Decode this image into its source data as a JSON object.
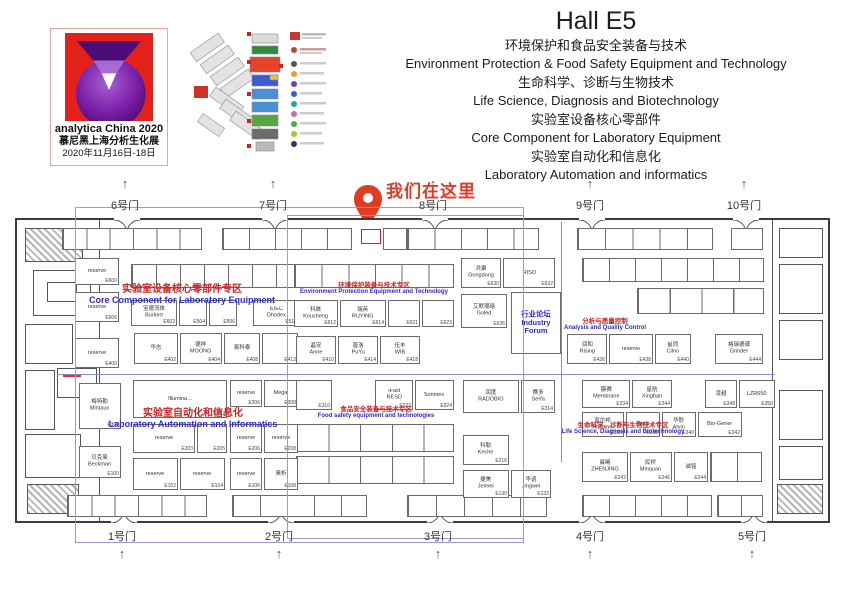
{
  "logo": {
    "name": "analytica China 2020",
    "subtitle": "慕尼黑上海分析生化展",
    "dates": "2020年11月16日-18日"
  },
  "header": {
    "title": "Hall E5",
    "lines": [
      "环境保护和食品安全装备与技术",
      "Environment Protection  & Food Safety Equipment and Technology",
      "生命科学、诊断与生物技术",
      "Life Science, Diagnosis and Biotechnology",
      "实验室设备核心零部件",
      "Core Component for Laboratory Equipment",
      "实验室自动化和信息化",
      "Laboratory Automation and informatics"
    ]
  },
  "marker": {
    "label": "我们在这里"
  },
  "gates": {
    "top": [
      {
        "label": "6号门",
        "x": 125
      },
      {
        "label": "7号门",
        "x": 273
      },
      {
        "label": "8号门",
        "x": 433
      },
      {
        "label": "9号门",
        "x": 590
      },
      {
        "label": "10号门",
        "x": 744
      }
    ],
    "bottom": [
      {
        "label": "1号门",
        "x": 122
      },
      {
        "label": "2号门",
        "x": 279
      },
      {
        "label": "3号门",
        "x": 438
      },
      {
        "label": "4号门",
        "x": 590
      },
      {
        "label": "5号门",
        "x": 752
      }
    ]
  },
  "zones": [
    {
      "cn": "实验室设备核心零部件专区",
      "en": "Core Component for Laboratory Equipment",
      "x": 82,
      "y": 280,
      "w": 200,
      "size": "lg"
    },
    {
      "cn": "环境保护装备与技术专区",
      "en": "Environment Protection Equipment and Technology",
      "x": 288,
      "y": 279,
      "w": 172,
      "size": "sm"
    },
    {
      "cn": "分析与质量控制",
      "en": "Analysis and Quality Control",
      "x": 540,
      "y": 315,
      "w": 130,
      "size": "sm"
    },
    {
      "cn": "实验室自动化和信息化",
      "en": "Laboratory Automation and Informatics",
      "x": 95,
      "y": 404,
      "w": 196,
      "size": "lg"
    },
    {
      "cn": "食品安全装备与技术专区",
      "en": "Food safety equipment and technologies",
      "x": 292,
      "y": 403,
      "w": 168,
      "size": "sm"
    },
    {
      "cn": "生命科学、诊断与生物技术专区",
      "en": "Life Science, Diagnosis and Biotechnology",
      "x": 542,
      "y": 419,
      "w": 162,
      "size": "sm"
    }
  ],
  "booths": [
    {
      "name": "reserve",
      "num": "E600",
      "x": 58,
      "y": 38,
      "w": 44,
      "h": 27
    },
    {
      "name": "reserve",
      "num": "E606",
      "x": 58,
      "y": 72,
      "w": 44,
      "h": 30
    },
    {
      "name": "reserve",
      "num": "E400",
      "x": 58,
      "y": 118,
      "w": 44,
      "h": 30
    },
    {
      "name": "宝德流体\nBurkert",
      "num": "E602",
      "x": 114,
      "y": 80,
      "w": 46,
      "h": 26
    },
    {
      "name": "",
      "num": "E504",
      "x": 162,
      "y": 80,
      "w": 28,
      "h": 26
    },
    {
      "name": "",
      "num": "E506",
      "x": 192,
      "y": 80,
      "w": 28,
      "h": 26
    },
    {
      "name": "IDEC\nDhodex",
      "num": "E510",
      "x": 236,
      "y": 80,
      "w": 46,
      "h": 26
    },
    {
      "name": "华志",
      "num": "E402",
      "x": 117,
      "y": 113,
      "w": 44,
      "h": 31
    },
    {
      "name": "德祥\nMOONG",
      "num": "E404",
      "x": 163,
      "y": 113,
      "w": 42,
      "h": 31
    },
    {
      "name": "易科泰",
      "num": "E408",
      "x": 207,
      "y": 113,
      "w": 36,
      "h": 31
    },
    {
      "name": "",
      "num": "E412",
      "x": 245,
      "y": 113,
      "w": 36,
      "h": 31
    },
    {
      "name": "科晟\nKousheng",
      "num": "E612",
      "x": 277,
      "y": 80,
      "w": 44,
      "h": 27
    },
    {
      "name": "瑞英\nRUYING",
      "num": "E614",
      "x": 323,
      "y": 80,
      "w": 46,
      "h": 27
    },
    {
      "name": "",
      "num": "E621",
      "x": 371,
      "y": 80,
      "w": 32,
      "h": 27
    },
    {
      "name": "",
      "num": "E623",
      "x": 405,
      "y": 80,
      "w": 32,
      "h": 27
    },
    {
      "name": "晶安\nAnne",
      "num": "E410",
      "x": 279,
      "y": 116,
      "w": 40,
      "h": 28
    },
    {
      "name": "普洛\nPuYu",
      "num": "E414",
      "x": 321,
      "y": 116,
      "w": 40,
      "h": 28
    },
    {
      "name": "伍丰\nWIB",
      "num": "E418",
      "x": 363,
      "y": 116,
      "w": 40,
      "h": 28
    },
    {
      "name": "共聚\nGongdong",
      "num": "E630",
      "x": 444,
      "y": 38,
      "w": 40,
      "h": 30
    },
    {
      "name": "RISO",
      "num": "E632",
      "x": 486,
      "y": 38,
      "w": 52,
      "h": 30
    },
    {
      "name": "艾默璎珞\nGoled",
      "num": "E636",
      "x": 444,
      "y": 74,
      "w": 46,
      "h": 34
    },
    {
      "name": "行业论坛\nIndustry Forum",
      "num": "",
      "style": "forum",
      "x": 494,
      "y": 72,
      "w": 50,
      "h": 62
    },
    {
      "name": "润和\nRising",
      "num": "E436",
      "x": 550,
      "y": 114,
      "w": 40,
      "h": 30
    },
    {
      "name": "reserve",
      "num": "E438",
      "x": 592,
      "y": 114,
      "w": 44,
      "h": 30
    },
    {
      "name": "星同\nCilno",
      "num": "E440",
      "x": 638,
      "y": 114,
      "w": 36,
      "h": 30
    },
    {
      "name": "格瑞德谱\nGrinder",
      "num": "E444",
      "x": 698,
      "y": 114,
      "w": 48,
      "h": 30
    },
    {
      "name": "梅特勒\nMintaux",
      "num": "E300",
      "x": 62,
      "y": 163,
      "w": 42,
      "h": 46
    },
    {
      "name": "贝克曼\nBeckman",
      "num": "E100",
      "x": 62,
      "y": 226,
      "w": 42,
      "h": 32
    },
    {
      "name": "Illumina…",
      "num": "E302",
      "x": 116,
      "y": 160,
      "w": 94,
      "h": 38
    },
    {
      "name": "reserve",
      "num": "E306",
      "x": 213,
      "y": 160,
      "w": 32,
      "h": 27
    },
    {
      "name": "Mega",
      "num": "E308",
      "x": 247,
      "y": 160,
      "w": 34,
      "h": 27
    },
    {
      "name": "reserve",
      "num": "E203",
      "x": 116,
      "y": 204,
      "w": 62,
      "h": 29
    },
    {
      "name": "",
      "num": "E205",
      "x": 180,
      "y": 204,
      "w": 30,
      "h": 29
    },
    {
      "name": "reserve",
      "num": "E206",
      "x": 213,
      "y": 204,
      "w": 32,
      "h": 29
    },
    {
      "name": "reserve",
      "num": "E208",
      "x": 247,
      "y": 204,
      "w": 34,
      "h": 29
    },
    {
      "name": "reserve",
      "num": "E102",
      "x": 116,
      "y": 238,
      "w": 45,
      "h": 32
    },
    {
      "name": "reserve",
      "num": "E104",
      "x": 163,
      "y": 238,
      "w": 45,
      "h": 32
    },
    {
      "name": "reserve",
      "num": "E106",
      "x": 213,
      "y": 238,
      "w": 32,
      "h": 32
    },
    {
      "name": "奥析",
      "num": "E108",
      "x": 247,
      "y": 238,
      "w": 34,
      "h": 32
    },
    {
      "name": "",
      "num": "E310",
      "x": 279,
      "y": 160,
      "w": 36,
      "h": 30
    },
    {
      "name": "iFast\nRESD",
      "num": "E322",
      "x": 358,
      "y": 160,
      "w": 38,
      "h": 30
    },
    {
      "name": "Sonmex",
      "num": "E324",
      "x": 398,
      "y": 160,
      "w": 39,
      "h": 30
    },
    {
      "name": "润度\nRADOBIO",
      "num": "",
      "x": 446,
      "y": 160,
      "w": 56,
      "h": 33
    },
    {
      "name": "赛多\nSerfa",
      "num": "E314",
      "x": 504,
      "y": 160,
      "w": 34,
      "h": 33
    },
    {
      "name": "科勒\nKeche",
      "num": "E216",
      "x": 446,
      "y": 215,
      "w": 46,
      "h": 30
    },
    {
      "name": "捷美\nJeimei",
      "num": "E130",
      "x": 446,
      "y": 250,
      "w": 46,
      "h": 28
    },
    {
      "name": "华谊\nJingwei",
      "num": "E132",
      "x": 494,
      "y": 250,
      "w": 40,
      "h": 28
    },
    {
      "name": "膜赛\nMembrane",
      "num": "E334",
      "x": 565,
      "y": 160,
      "w": 48,
      "h": 28
    },
    {
      "name": "星航\nXinghan",
      "num": "E344",
      "x": 615,
      "y": 160,
      "w": 40,
      "h": 28
    },
    {
      "name": "凌越",
      "num": "E348",
      "x": 688,
      "y": 160,
      "w": 32,
      "h": 28
    },
    {
      "name": "LZR650",
      "num": "E350",
      "x": 722,
      "y": 160,
      "w": 36,
      "h": 28
    },
    {
      "name": "富尔邦\nFulltime",
      "num": "E338",
      "x": 565,
      "y": 192,
      "w": 42,
      "h": 25
    },
    {
      "name": "Tan's",
      "num": "E336",
      "x": 609,
      "y": 192,
      "w": 34,
      "h": 25
    },
    {
      "name": "华聆\nAtvio",
      "num": "E340",
      "x": 645,
      "y": 192,
      "w": 34,
      "h": 25
    },
    {
      "name": "Bio-Gener",
      "num": "E342",
      "x": 681,
      "y": 192,
      "w": 44,
      "h": 25
    },
    {
      "name": "晨曦\nZHENJING",
      "num": "E242",
      "x": 565,
      "y": 232,
      "w": 46,
      "h": 30
    },
    {
      "name": "民桥\nMinquan",
      "num": "E246",
      "x": 613,
      "y": 232,
      "w": 42,
      "h": 30
    },
    {
      "name": "诚铭",
      "num": "E244",
      "x": 657,
      "y": 232,
      "w": 34,
      "h": 30
    }
  ],
  "booth_strips": [
    {
      "x": 45,
      "y": 8,
      "w": 140,
      "h": 22,
      "cells": 6
    },
    {
      "x": 205,
      "y": 8,
      "w": 130,
      "h": 22,
      "cells": 5
    },
    {
      "x": 366,
      "y": 8,
      "w": 24,
      "h": 22,
      "cells": 1
    },
    {
      "x": 390,
      "y": 8,
      "w": 132,
      "h": 22,
      "cells": 5
    },
    {
      "x": 560,
      "y": 8,
      "w": 136,
      "h": 22,
      "cells": 5
    },
    {
      "x": 714,
      "y": 8,
      "w": 32,
      "h": 22,
      "cells": 1
    },
    {
      "x": 114,
      "y": 44,
      "w": 168,
      "h": 24,
      "cells": 7
    },
    {
      "x": 277,
      "y": 44,
      "w": 160,
      "h": 24,
      "cells": 6
    },
    {
      "x": 565,
      "y": 38,
      "w": 182,
      "h": 24,
      "cells": 7
    },
    {
      "x": 620,
      "y": 68,
      "w": 127,
      "h": 26,
      "cells": 4
    },
    {
      "x": 279,
      "y": 204,
      "w": 158,
      "h": 28,
      "cells": 5
    },
    {
      "x": 279,
      "y": 236,
      "w": 158,
      "h": 28,
      "cells": 5
    },
    {
      "x": 693,
      "y": 232,
      "w": 52,
      "h": 30,
      "cells": 2
    },
    {
      "x": 50,
      "y": 275,
      "w": 140,
      "h": 22,
      "cells": 6
    },
    {
      "x": 215,
      "y": 275,
      "w": 135,
      "h": 22,
      "cells": 5
    },
    {
      "x": 390,
      "y": 275,
      "w": 140,
      "h": 22,
      "cells": 5
    },
    {
      "x": 565,
      "y": 275,
      "w": 130,
      "h": 22,
      "cells": 5
    },
    {
      "x": 700,
      "y": 275,
      "w": 46,
      "h": 22,
      "cells": 2
    }
  ],
  "highlight_booth": {
    "x": 344,
    "y": 9,
    "w": 20,
    "h": 15
  },
  "colors": {
    "accent_red": "#e23b24",
    "zone_text_red": "#cc2222",
    "zone_text_blue": "#2b2bd0",
    "overlay_blue": "#9a9ad9",
    "logo_red": "#e32119",
    "logo_purple": "#7a1fa8"
  }
}
